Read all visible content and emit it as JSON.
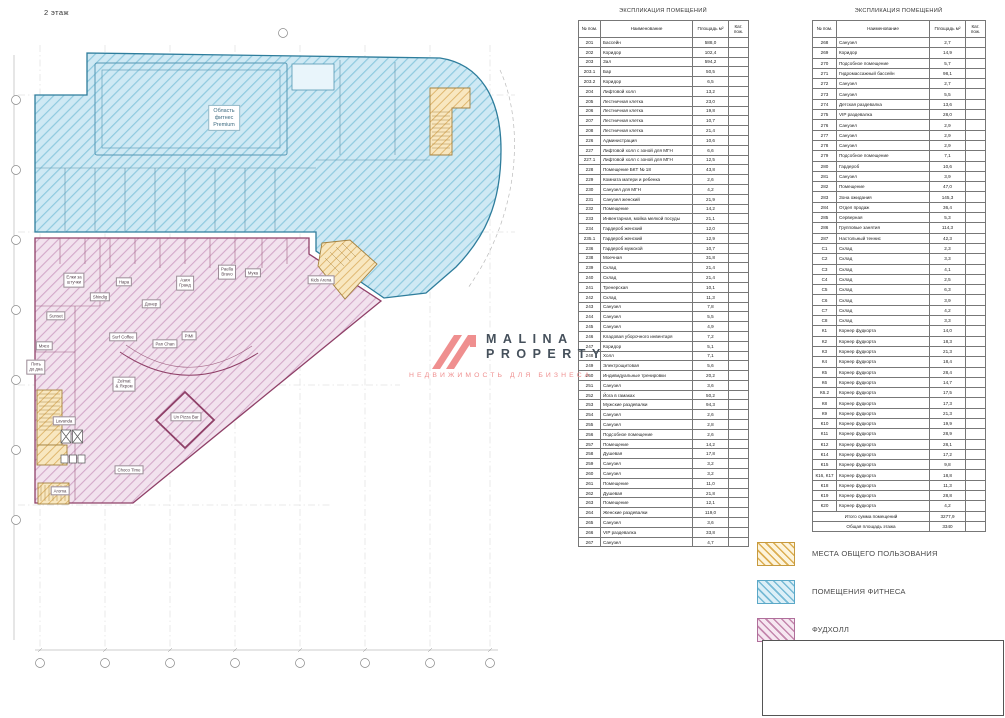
{
  "page": {
    "floor_label": "2 этаж"
  },
  "watermark": {
    "title_line1": "MALINA",
    "title_line2": "PROPERTY",
    "subtitle": "НЕДВИЖИМОСТЬ ДЛЯ БИЗНЕСА",
    "logo_color": "#ef8f8f",
    "title_color": "#45505b"
  },
  "tables": [
    {
      "title": "ЭКСПЛИКАЦИЯ ПОМЕЩЕНИЙ",
      "columns": [
        "№ пом.",
        "Наименование",
        "Площадь м²",
        "Кат. пож."
      ],
      "rows": [
        [
          "201",
          "Бассейн",
          "588,0"
        ],
        [
          "202",
          "Коридор",
          "102,4"
        ],
        [
          "203",
          "Зал",
          "594,2"
        ],
        [
          "203.1",
          "Бар",
          "50,5"
        ],
        [
          "203.2",
          "Коридор",
          "6,5"
        ],
        [
          "204",
          "Лифтовой холл",
          "13,2"
        ],
        [
          "205",
          "Лестничная клетка",
          "23,0"
        ],
        [
          "206",
          "Лестничная клетка",
          "19,8"
        ],
        [
          "207",
          "Лестничная клетка",
          "10,7"
        ],
        [
          "208",
          "Лестничная клетка",
          "21,4"
        ],
        [
          "226",
          "Администрация",
          "10,6"
        ],
        [
          "227",
          "Лифтовой холл с зоной для МГН",
          "6,6"
        ],
        [
          "227.1",
          "Лифтовой холл с зоной для МГН",
          "12,5"
        ],
        [
          "228",
          "Помещение БКТ № 18",
          "43,8"
        ],
        [
          "229",
          "Комната матери и ребенка",
          "2,6"
        ],
        [
          "230",
          "Санузел для МГН",
          "4,2"
        ],
        [
          "231",
          "Санузел женский",
          "21,9"
        ],
        [
          "232",
          "Помещение",
          "14,2"
        ],
        [
          "233",
          "Инвентарная, мойка мелкой посуды",
          "21,1"
        ],
        [
          "234",
          "Гардероб женский",
          "12,0"
        ],
        [
          "235.1",
          "Гардероб женский",
          "12,9"
        ],
        [
          "236",
          "Гардероб мужской",
          "10,7"
        ],
        [
          "238",
          "Моечная",
          "31,8"
        ],
        [
          "239",
          "Склад",
          "21,4"
        ],
        [
          "240",
          "Склад",
          "21,4"
        ],
        [
          "241",
          "Тренерская",
          "10,1"
        ],
        [
          "242",
          "Склад",
          "11,3"
        ],
        [
          "243",
          "Санузел",
          "7,8"
        ],
        [
          "244",
          "Санузел",
          "5,5"
        ],
        [
          "245",
          "Санузел",
          "4,9"
        ],
        [
          "246",
          "Кладовая уборочного инвентаря",
          "7,2"
        ],
        [
          "247",
          "Коридор",
          "5,1"
        ],
        [
          "248",
          "Холл",
          "7,1"
        ],
        [
          "249",
          "Электрощитовая",
          "5,6"
        ],
        [
          "250",
          "Индивидуальные тренировки",
          "20,2"
        ],
        [
          "251",
          "Санузел",
          "3,6"
        ],
        [
          "252",
          "Йога в гамаках",
          "50,2"
        ],
        [
          "253",
          "Мужские раздевалки",
          "94,3"
        ],
        [
          "254",
          "Санузел",
          "2,6"
        ],
        [
          "255",
          "Санузел",
          "2,8"
        ],
        [
          "256",
          "Подсобное помещение",
          "2,6"
        ],
        [
          "257",
          "Помещение",
          "14,2"
        ],
        [
          "258",
          "Душевая",
          "17,8"
        ],
        [
          "259",
          "Санузел",
          "3,2"
        ],
        [
          "260",
          "Санузел",
          "3,2"
        ],
        [
          "261",
          "Помещение",
          "11,0"
        ],
        [
          "262",
          "Душевая",
          "21,8"
        ],
        [
          "263",
          "Помещение",
          "12,1"
        ],
        [
          "264",
          "Женские раздевалки",
          "119,0"
        ],
        [
          "265",
          "Санузел",
          "3,6"
        ],
        [
          "266",
          "VIP раздевалка",
          "33,8"
        ],
        [
          "267",
          "Санузел",
          "4,7"
        ]
      ],
      "totals": []
    },
    {
      "title": "ЭКСПЛИКАЦИЯ ПОМЕЩЕНИЙ",
      "columns": [
        "№ пом.",
        "Наименование",
        "Площадь м²",
        "Кат. пож."
      ],
      "rows": [
        [
          "268",
          "Санузел",
          "2,7"
        ],
        [
          "269",
          "Коридор",
          "14,9"
        ],
        [
          "270",
          "Подсобное помещение",
          "5,7"
        ],
        [
          "271",
          "Гидромассажный бассейн",
          "98,1"
        ],
        [
          "272",
          "Санузел",
          "2,7"
        ],
        [
          "273",
          "Санузел",
          "5,5"
        ],
        [
          "274",
          "Детская раздевалка",
          "13,6"
        ],
        [
          "275",
          "VIP раздевалка",
          "28,0"
        ],
        [
          "276",
          "Санузел",
          "2,9"
        ],
        [
          "277",
          "Санузел",
          "2,9"
        ],
        [
          "278",
          "Санузел",
          "2,9"
        ],
        [
          "279",
          "Подсобное помещение",
          "7,1"
        ],
        [
          "280",
          "Гардероб",
          "10,6"
        ],
        [
          "281",
          "Санузел",
          "3,9"
        ],
        [
          "282",
          "Помещение",
          "47,0"
        ],
        [
          "283",
          "Зона ожидания",
          "145,3"
        ],
        [
          "284",
          "Отдел продаж",
          "36,4"
        ],
        [
          "285",
          "Серверная",
          "5,3"
        ],
        [
          "286",
          "Групповые занятия",
          "114,3"
        ],
        [
          "287",
          "Настольный теннис",
          "42,3"
        ],
        [
          "С1",
          "Склад",
          "2,3"
        ],
        [
          "С2",
          "Склад",
          "3,3"
        ],
        [
          "С3",
          "Склад",
          "4,1"
        ],
        [
          "С4",
          "Склад",
          "2,5"
        ],
        [
          "С5",
          "Склад",
          "6,3"
        ],
        [
          "С6",
          "Склад",
          "3,9"
        ],
        [
          "С7",
          "Склад",
          "4,2"
        ],
        [
          "С8",
          "Склад",
          "3,3"
        ],
        [
          "К1",
          "Корнер фудкорта",
          "14,0"
        ],
        [
          "К2",
          "Корнер фудкорта",
          "18,3"
        ],
        [
          "К3",
          "Корнер фудкорта",
          "21,3"
        ],
        [
          "К4",
          "Корнер фудкорта",
          "18,4"
        ],
        [
          "К5",
          "Корнер фудкорта",
          "28,4"
        ],
        [
          "К6",
          "Корнер фудкорта",
          "14,7"
        ],
        [
          "К6.2",
          "Корнер фудкорта",
          "17,5"
        ],
        [
          "К8",
          "Корнер фудкорта",
          "17,3"
        ],
        [
          "К9",
          "Корнер фудкорта",
          "21,3"
        ],
        [
          "К10",
          "Корнер фудкорта",
          "19,9"
        ],
        [
          "К11",
          "Корнер фудкорта",
          "28,9"
        ],
        [
          "К12",
          "Корнер фудкорта",
          "28,1"
        ],
        [
          "К14",
          "Корнер фудкорта",
          "17,2"
        ],
        [
          "К15",
          "Корнер фудкорта",
          "9,8"
        ],
        [
          "К16, К17",
          "Корнер фудкорта",
          "18,8"
        ],
        [
          "К18",
          "Корнер фудкорта",
          "11,3"
        ],
        [
          "К19",
          "Корнер фудкорта",
          "28,8"
        ],
        [
          "К20",
          "Корнер фудкорта",
          "4,2"
        ]
      ],
      "totals": [
        [
          "Итого сумма помещений",
          "3277,9"
        ],
        [
          "Общая площадь этажа",
          "3340"
        ]
      ]
    }
  ],
  "legend": {
    "items": [
      {
        "label": "МЕСТА ОБЩЕГО ПОЛЬЗОВАНИЯ",
        "fill": "#fdf4dc",
        "hatch": "#dcae52",
        "border": "#c79a3e"
      },
      {
        "label": "ПОМЕЩЕНИЯ ФИТНЕСА",
        "fill": "#dcEFF7",
        "hatch": "#76bad5",
        "border": "#5ba8c7"
      },
      {
        "label": "ФУДХОЛЛ",
        "fill": "#f6e7f1",
        "hatch": "#c487ad",
        "border": "#b06f9b"
      }
    ]
  },
  "plan": {
    "zone_colors": {
      "fitness_fill": "#cfe9f4",
      "fitness_hatch": "#8fcadf",
      "fitness_border": "#2e7d9c",
      "foodhall_fill": "#f2e2ee",
      "foodhall_hatch": "#d3a9c9",
      "foodhall_border": "#8f4068",
      "common_fill": "#f8e7c0",
      "common_hatch": "#ddb368",
      "common_border": "#a5823f"
    },
    "labels": [
      {
        "text": "Область\nфитнес\nPremium",
        "x": 224,
        "y": 118,
        "big": true
      },
      {
        "text": "Елки за\nштучки",
        "x": 74,
        "y": 280
      },
      {
        "text": "Нара",
        "x": 124,
        "y": 282
      },
      {
        "text": "Shindig",
        "x": 100,
        "y": 297
      },
      {
        "text": "Донер",
        "x": 151,
        "y": 304
      },
      {
        "text": "Азия\nГранд",
        "x": 185,
        "y": 283
      },
      {
        "text": "Paella\nBravo",
        "x": 227,
        "y": 272
      },
      {
        "text": "Мука",
        "x": 253,
        "y": 273
      },
      {
        "text": "Kids Arena",
        "x": 321,
        "y": 280
      },
      {
        "text": "Sunset",
        "x": 56,
        "y": 316
      },
      {
        "text": "Мясо",
        "x": 44,
        "y": 346
      },
      {
        "text": "Пить\nдо дна",
        "x": 36,
        "y": 367
      },
      {
        "text": "Surf Coffee",
        "x": 123,
        "y": 337
      },
      {
        "text": "Pan Chan",
        "x": 165,
        "y": 344
      },
      {
        "text": "PIMI",
        "x": 189,
        "y": 336
      },
      {
        "text": "Zelmat\n& Яхром",
        "x": 124,
        "y": 384
      },
      {
        "text": "Un Pizza Bar",
        "x": 186,
        "y": 417
      },
      {
        "text": "Lavanda",
        "x": 64,
        "y": 421
      },
      {
        "text": "Choco Time",
        "x": 129,
        "y": 470
      },
      {
        "text": "Aroma",
        "x": 60,
        "y": 491
      }
    ]
  }
}
